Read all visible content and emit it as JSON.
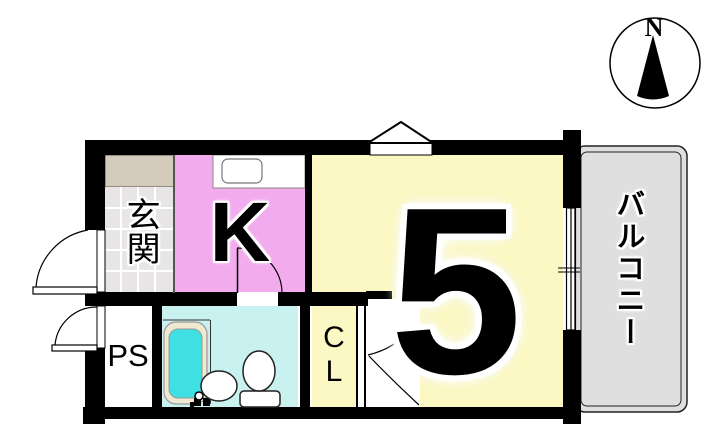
{
  "floor_plan": {
    "rooms": {
      "entrance": "玄関",
      "kitchen": "K",
      "main_room": "5",
      "balcony": "バルコニー",
      "pipe_space": "PS",
      "closet_line1": "C",
      "closet_line2": "L"
    },
    "compass": {
      "north": "N"
    },
    "colors": {
      "kitchen": "#F2ACEE",
      "main_room": "#FBF8C3",
      "bathroom": "#C9F1EF",
      "bathtub_water": "#3EE0E2",
      "bathtub_rim": "#EFE9D2",
      "entrance_cabinet": "#D5CBBC",
      "entrance_tile": "#E7E5E5",
      "balcony": "#DFDFDF",
      "wall": "#000000"
    }
  }
}
